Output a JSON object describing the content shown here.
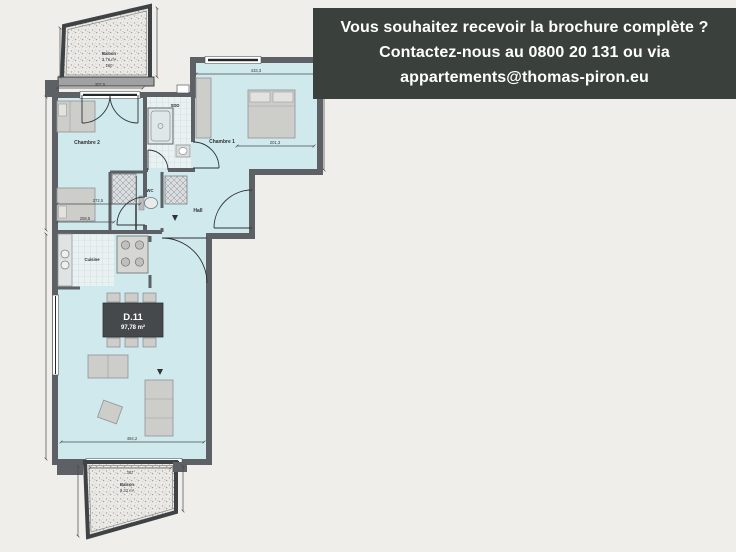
{
  "banner": {
    "line1": "Vous souhaitez recevoir la brochure complète ?",
    "line2": "Contactez-nous au 0800 20 131 ou via",
    "line3": "appartements@thomas-piron.eu",
    "background": "#3a413d",
    "text_color": "#ffffff"
  },
  "plan": {
    "unit": {
      "id": "D.11",
      "area": "97,78 m²"
    },
    "rooms": {
      "chambre2": "Chambre 2",
      "chambre1": "Chambre 1",
      "sdd": "SDD",
      "wc": "WC",
      "hall": "Hall",
      "cuisine": "Cuisine"
    },
    "balconies": {
      "top": {
        "name": "Balcon",
        "area": "3,76 m²",
        "width_label": "260"
      },
      "bottom": {
        "name": "Balcon",
        "area": "9,32 m²"
      }
    },
    "dimensions": {
      "chambre2_top": "307,5",
      "chambre1_width": "433,3",
      "chambre1_inner": "201,3",
      "chambre2_lower": "272,5",
      "corridor": "258,5",
      "sejour_width": "484,2",
      "balcon_bottom_width": "307"
    },
    "colors": {
      "room_fill": "#cfe9ed",
      "wall": "#5d6165",
      "balcony_border": "#3e4245",
      "background": "#f0eeea"
    }
  }
}
